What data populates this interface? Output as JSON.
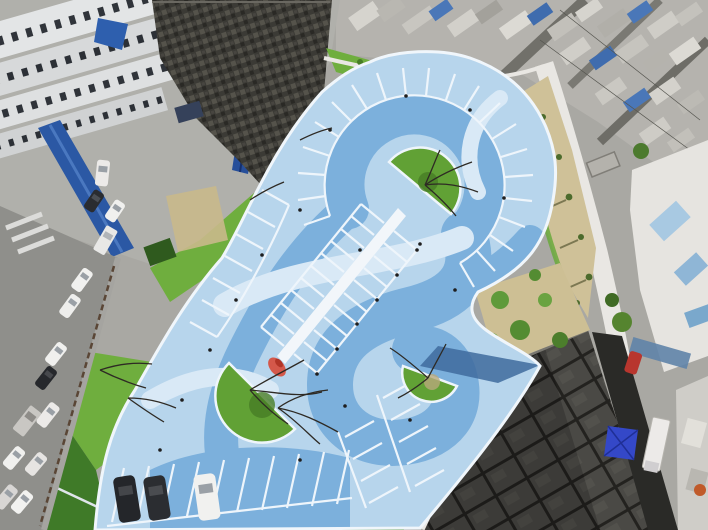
{
  "scene": {
    "description": "Aerial drone view of an S-shaped blue-painted parking lot with white stall markings inside a dense urban residential block",
    "time_of_day": "daytime, sunny",
    "palette": {
      "lot_base": "#b7d5ec",
      "lot_swirl": "#7cb0dc",
      "lot_pale": "#d9e9f6",
      "lot_shadow": "#3f6b9d",
      "stall_line": "#eef5fb",
      "island_green": "#61a135",
      "island_green_dark": "#477d25",
      "grass": "#6fae3e",
      "grass_dark": "#3f7a28",
      "dry_grass": "#cfc198",
      "street": "#8f8f8b",
      "pavement": "#a9a8a3",
      "building_white": "#e2e2de",
      "roof_blue": "#2d5ca6",
      "alley": "#2a2a27",
      "tent_blue": "#3448c8",
      "car_dark": "#24262a",
      "car_white": "#f1f1ef",
      "red_accent": "#d4584a",
      "path_white": "#e9e7e3"
    },
    "parking_lot": {
      "shape": "organic swirl with top loop and bottom hook",
      "surface_pattern": "two-tone blue S-curve swirl with pale wisps",
      "islands": [
        {
          "position": "top-loop",
          "shape": "semicircle",
          "vegetation": "grass with bare tree"
        },
        {
          "position": "bottom-left",
          "shape": "semicircle",
          "vegetation": "grass with two bare trees"
        },
        {
          "position": "bottom-right",
          "shape": "semicircle",
          "vegetation": "grass with bare tree"
        }
      ],
      "median_walkway": {
        "color": "white",
        "lamps": 6,
        "end_feature": "red sculpture"
      },
      "stall_bands": 5,
      "parked_cars": [
        {
          "color": "dark"
        },
        {
          "color": "dark"
        },
        {
          "color": "white"
        }
      ]
    },
    "surroundings": {
      "north_west": "white apartment slabs with window rows, long blue roofs, old dark tiled roof",
      "north_east": "dense mosaic of small rooftops with scattered blue roofs and diagonal lanes",
      "east": "dry grass slope with sparse trees, white footpath, white buildings with blue glass",
      "south_east": "large dark tiled roofs, narrow alley with blue tent and white truck and red car",
      "west": "street with parked vehicles behind a fence, green lawn wedges"
    },
    "vehicles": {
      "street_parked": 14,
      "alley": [
        "white truck",
        "red car"
      ],
      "lot": 3
    }
  }
}
